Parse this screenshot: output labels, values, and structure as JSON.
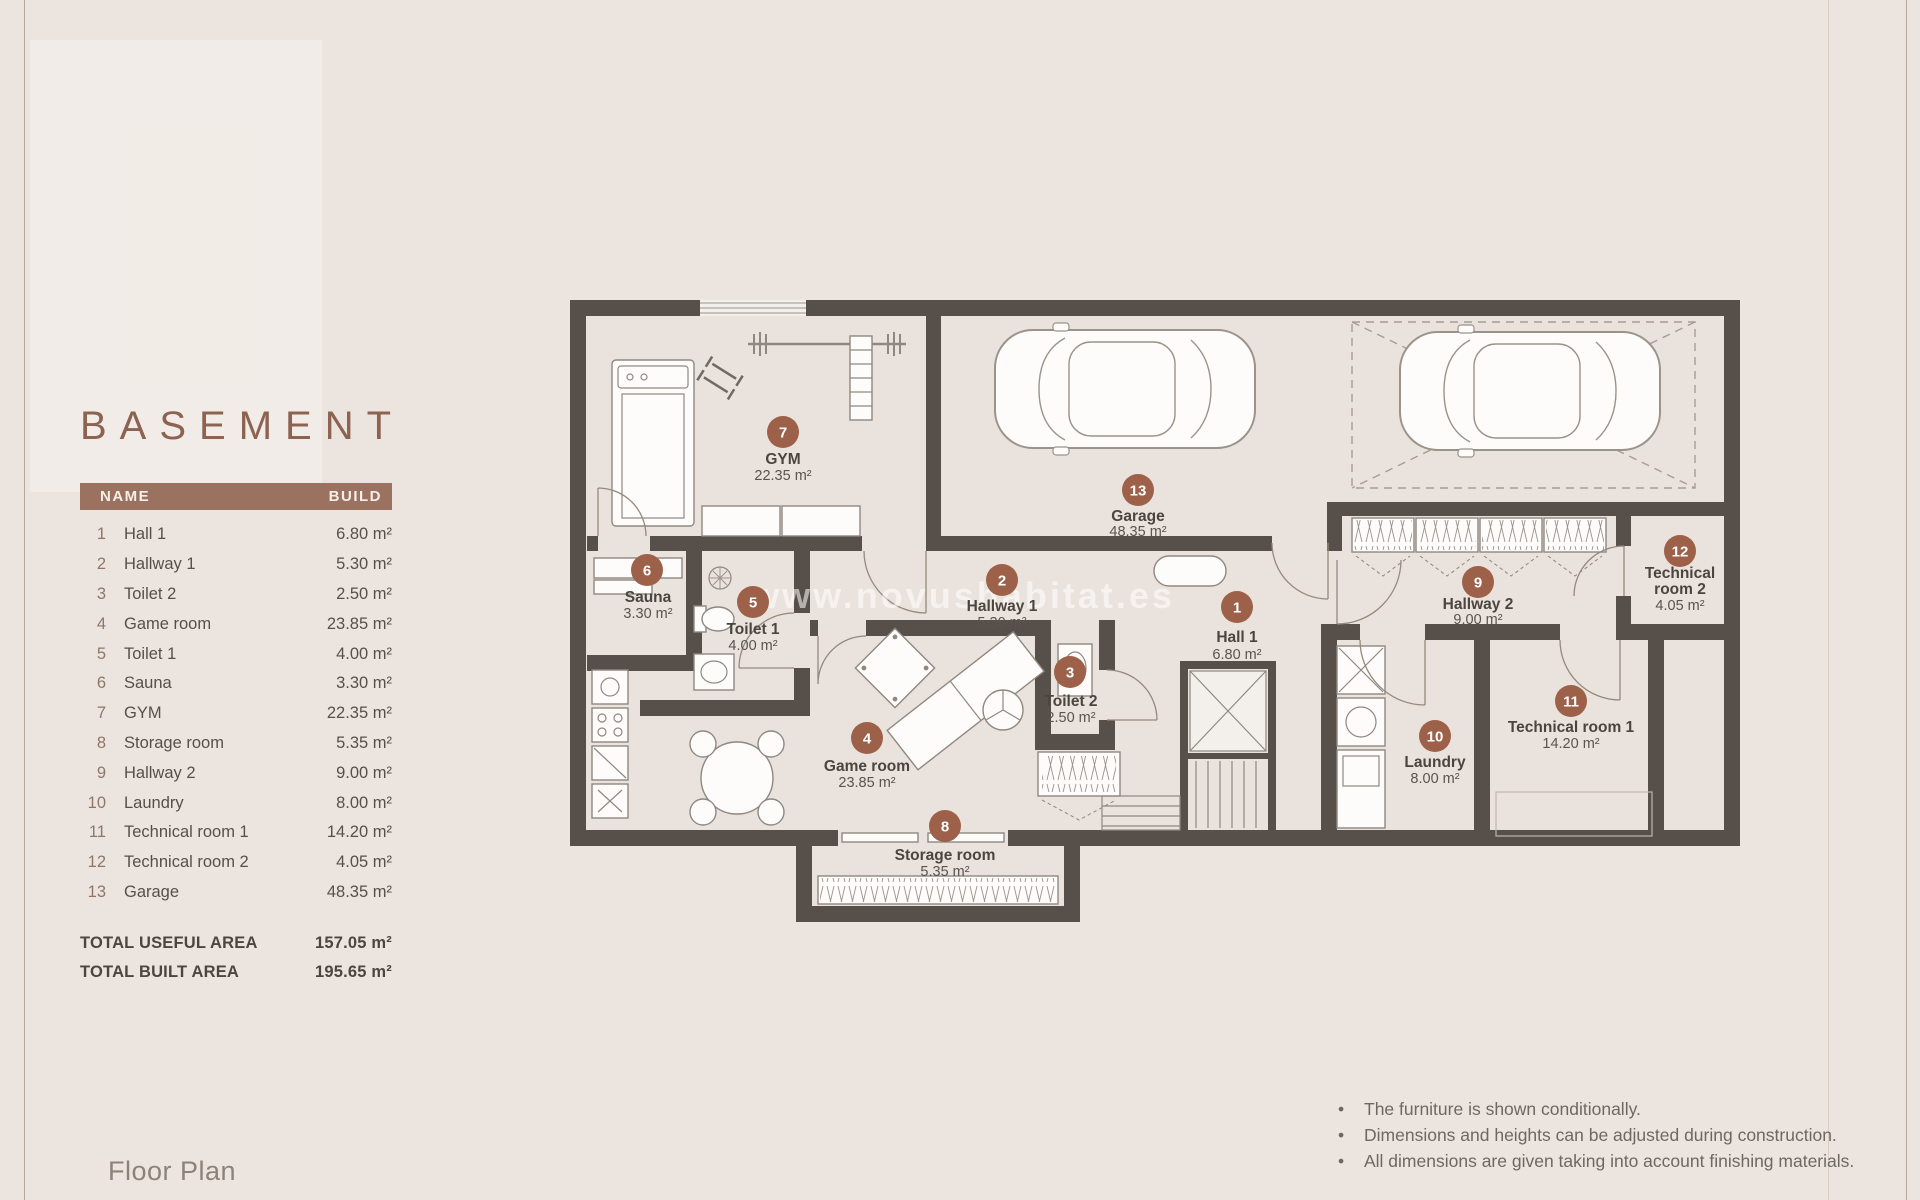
{
  "page": {
    "background": "#ece5df",
    "accent": "#9d6049",
    "wall_color": "#57504a",
    "footer_label": "Floor Plan"
  },
  "sidebar": {
    "title": "BASEMENT",
    "table": {
      "header": {
        "name": "NAME",
        "build": "BUILD"
      },
      "rows": [
        {
          "num": "1",
          "name": "Hall 1",
          "area": "6.80 m²"
        },
        {
          "num": "2",
          "name": "Hallway 1",
          "area": "5.30 m²"
        },
        {
          "num": "3",
          "name": "Toilet 2",
          "area": "2.50 m²"
        },
        {
          "num": "4",
          "name": "Game room",
          "area": "23.85 m²"
        },
        {
          "num": "5",
          "name": "Toilet 1",
          "area": "4.00 m²"
        },
        {
          "num": "6",
          "name": "Sauna",
          "area": "3.30 m²"
        },
        {
          "num": "7",
          "name": "GYM",
          "area": "22.35 m²"
        },
        {
          "num": "8",
          "name": "Storage room",
          "area": "5.35 m²"
        },
        {
          "num": "9",
          "name": "Hallway 2",
          "area": "9.00 m²"
        },
        {
          "num": "10",
          "name": "Laundry",
          "area": "8.00 m²"
        },
        {
          "num": "11",
          "name": "Technical room 1",
          "area": "14.20 m²"
        },
        {
          "num": "12",
          "name": "Technical room 2",
          "area": "4.05 m²"
        },
        {
          "num": "13",
          "name": "Garage",
          "area": "48.35 m²"
        }
      ],
      "totals": [
        {
          "label": "TOTAL USEFUL AREA",
          "value": "157.05 m²"
        },
        {
          "label": "TOTAL BUILT AREA",
          "value": "195.65 m²"
        }
      ]
    }
  },
  "plan": {
    "watermark": "www.novushabitat.es",
    "rooms": [
      {
        "num": "1",
        "name": "Hall 1",
        "area": "6.80 m²"
      },
      {
        "num": "2",
        "name": "Hallway 1",
        "area": "5.30 m²"
      },
      {
        "num": "3",
        "name": "Toilet 2",
        "area": "2.50 m²"
      },
      {
        "num": "4",
        "name": "Game room",
        "area": "23.85 m²"
      },
      {
        "num": "5",
        "name": "Toilet 1",
        "area": "4.00 m²"
      },
      {
        "num": "6",
        "name": "Sauna",
        "area": "3.30 m²"
      },
      {
        "num": "7",
        "name": "GYM",
        "area": "22.35 m²"
      },
      {
        "num": "8",
        "name": "Storage room",
        "area": "5.35 m²"
      },
      {
        "num": "9",
        "name": "Hallway 2",
        "area": "9.00 m²"
      },
      {
        "num": "10",
        "name": "Laundry",
        "area": "8.00 m²"
      },
      {
        "num": "11",
        "name": "Technical room 1",
        "area": "14.20 m²"
      },
      {
        "num": "12",
        "name_l1": "Technical",
        "name_l2": "room 2",
        "area": "4.05 m²"
      },
      {
        "num": "13",
        "name": "Garage",
        "area": "48.35 m²"
      }
    ]
  },
  "notes": {
    "items": [
      "The furniture is shown conditionally.",
      "Dimensions and heights can be adjusted during construction.",
      "All dimensions are given taking into account finishing materials."
    ]
  }
}
